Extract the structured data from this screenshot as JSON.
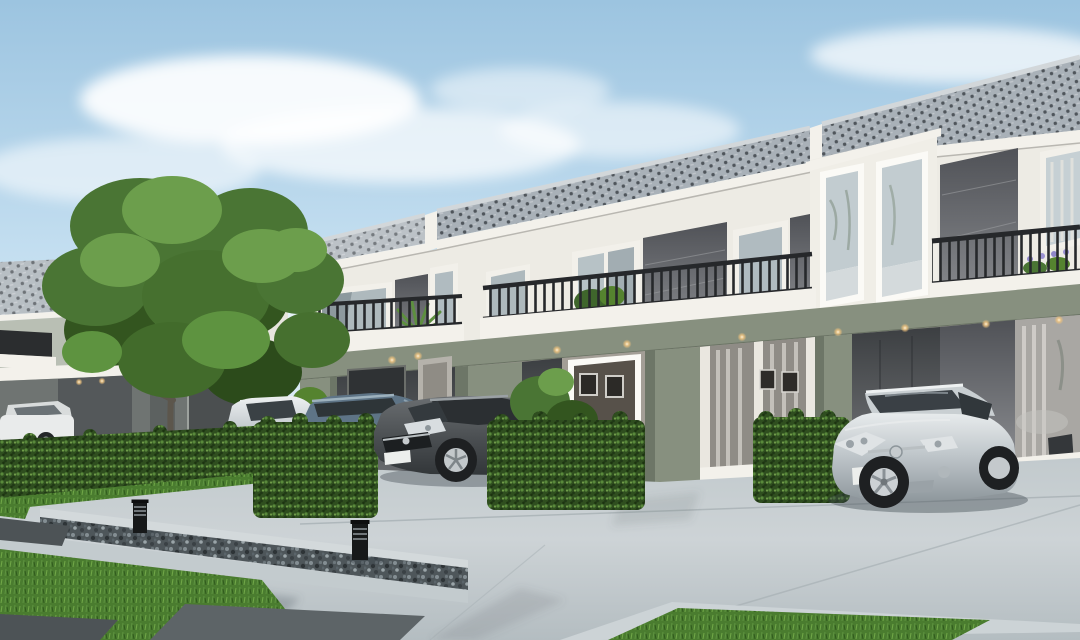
{
  "scene": {
    "type": "architectural-exterior-render",
    "description": "Daytime 3D rendering of a modern two-storey townhouse row with carports, parked cars, trimmed hedges, a detached house at left, a large tree, bollard lights and a concrete driveway under a blue sky with soft clouds",
    "time_of_day": "day",
    "visible_text": ""
  },
  "palette": {
    "sky_top": "#9cc4e0",
    "sky_mid": "#c3def0",
    "sky_low": "#eaf3f8",
    "cloud": "#ffffff",
    "roof_base": "#a9b1b8",
    "roof_dot": "#3f454b",
    "roof_ridge": "#d2d7da",
    "fascia": "#f3f1eb",
    "facade": "#edebe4",
    "facade_shade": "#dddbd3",
    "panel_dark": "#55575c",
    "panel_light": "#8d8f93",
    "railing": "#26282b",
    "sage": "#87907f",
    "sage_dark": "#6d7667",
    "ground_wall": "#98948b",
    "carport_dark": "#3c3f42",
    "glass": "#b6c1c6",
    "glass_dark": "#6e787d",
    "curtain": "#d9d6d0",
    "interior_dark": "#55504a",
    "warm_light": "#ffe9c2",
    "hedge": "#2f4e1f",
    "hedge_light": "#5c8c3c",
    "hedge_dark": "#203816",
    "grass": "#4a7c2f",
    "grass_light": "#71a848",
    "driveway": "#cdd3d6",
    "sidewalk": "#c3cbce",
    "curb": "#ccd3d6",
    "slab": "#5d6467",
    "slab_dark": "#4d5356",
    "gravel": "#4e565a",
    "trunk": "#5c564c",
    "foliage": "#4a7534",
    "foliage_light": "#6c9e4c",
    "foliage_dark": "#33551f",
    "flower_purple": "#8f86c8",
    "car_white": "#e9ebeb",
    "car_silver": "#c7ccce",
    "car_blue": "#5e7486",
    "car_dark": "#54585a",
    "tire": "#1e2022",
    "alloy": "#c3c8cb",
    "plate": "#eceeec",
    "shadow": "#39434a"
  },
  "objects": {
    "buildings": [
      {
        "name": "townhouse-row",
        "storeys": 2,
        "roof": "grey concrete tile",
        "walls": "white with dark grey feature panels and sage-green ground band",
        "balconies": 3,
        "carports": 2
      },
      {
        "name": "detached-house-left",
        "storeys": 2,
        "roof": "grey tile",
        "walls": "light grey upper, dark grey lower"
      }
    ],
    "cars": [
      {
        "name": "white-sedan-far-left",
        "color": "#e9ebeb"
      },
      {
        "name": "silver-suv",
        "color": "#c7ccce"
      },
      {
        "name": "blue-grey-hatchback",
        "color": "#5e7486"
      },
      {
        "name": "dark-grey-coupe",
        "color": "#54585a"
      },
      {
        "name": "silver-coupe-right",
        "color": "#c7ccce"
      }
    ],
    "landscape": {
      "hedge_boxes": 4,
      "hedge_row": 1,
      "large_tree": 1,
      "balcony_plants": 3,
      "bollard_lights": 2,
      "gravel_strip": 1,
      "lawn_patches": 2
    },
    "lighting": {
      "downlights_count": 9,
      "downlight_tint": "#ffe9c2"
    }
  }
}
